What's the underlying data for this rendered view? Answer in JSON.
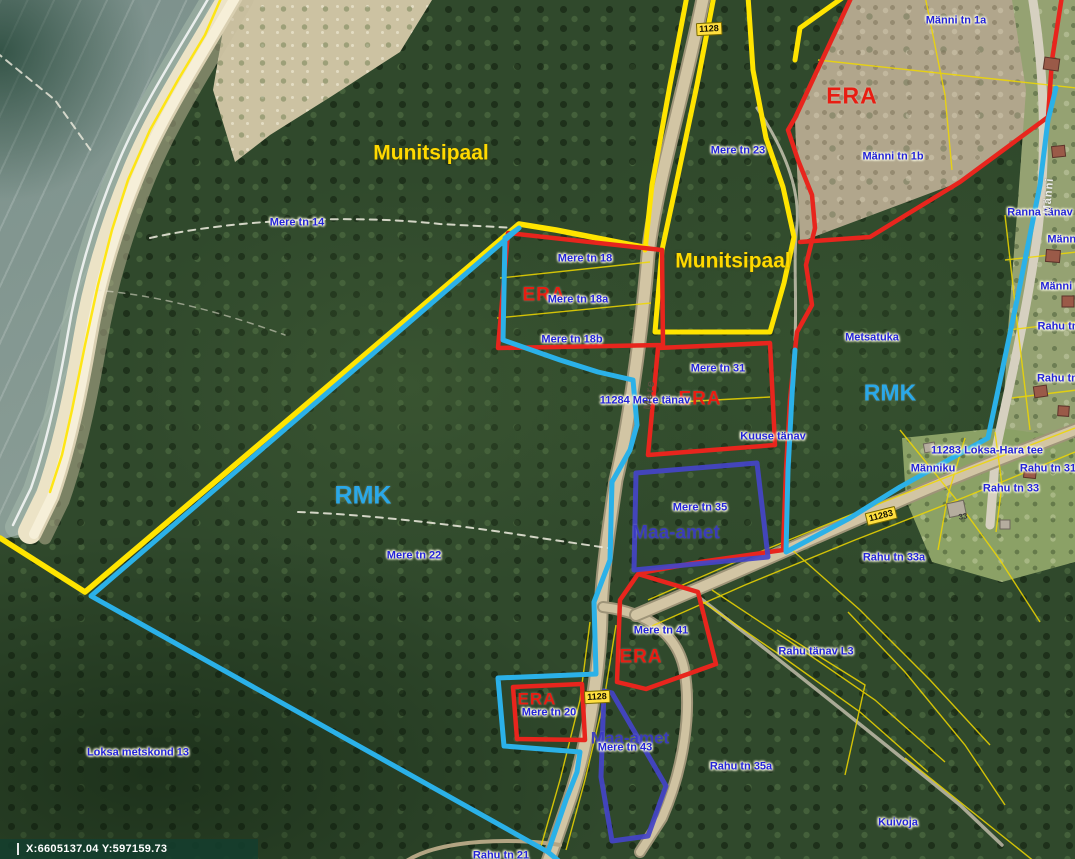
{
  "colors": {
    "boundary_yellow_municipal": "#ffe400",
    "boundary_red_era": "#e8251d",
    "boundary_cyan_rmk": "#2bb1e8",
    "boundary_purple_state": "#4444c8",
    "parcel_label_blue": "#2323d8",
    "road_badge_yellow": "#ffdf3f",
    "status_bar_green": "#143e2e"
  },
  "map": {
    "status_bar": {
      "coordinates": "X:6605137.04 Y:597159.73"
    },
    "badges": [
      {
        "text": "1128",
        "x": 709,
        "y": 29,
        "rot": -3
      },
      {
        "text": "11283",
        "x": 881,
        "y": 516,
        "rot": -14
      },
      {
        "text": "1128",
        "x": 597,
        "y": 697,
        "rot": -3
      }
    ],
    "labels": [
      {
        "text": "Munitsipaal",
        "x": 431,
        "y": 153,
        "type": "munitsipaal"
      },
      {
        "text": "Munitsipaal",
        "x": 733,
        "y": 261,
        "type": "munitsipaal"
      },
      {
        "text": "ERA",
        "x": 852,
        "y": 96,
        "type": "era",
        "size": 23
      },
      {
        "text": "ERA",
        "x": 544,
        "y": 295,
        "type": "era"
      },
      {
        "text": "ERA",
        "x": 700,
        "y": 399,
        "type": "era"
      },
      {
        "text": "ERA",
        "x": 641,
        "y": 657,
        "type": "era"
      },
      {
        "text": "ERA",
        "x": 537,
        "y": 699,
        "type": "era",
        "size": 17
      },
      {
        "text": "RMK",
        "x": 363,
        "y": 496,
        "type": "rmk",
        "size": 25
      },
      {
        "text": "RMK",
        "x": 890,
        "y": 393,
        "type": "rmk",
        "size": 23
      },
      {
        "text": "Maa-amet",
        "x": 676,
        "y": 533,
        "type": "maa"
      },
      {
        "text": "Maa-amet",
        "x": 630,
        "y": 738,
        "type": "maa",
        "size": 17
      },
      {
        "text": "Mere tn 14",
        "x": 297,
        "y": 223,
        "type": "parcel"
      },
      {
        "text": "Mere tn 23",
        "x": 738,
        "y": 151,
        "type": "parcel"
      },
      {
        "text": "Männi tn 1a",
        "x": 956,
        "y": 21,
        "type": "parcel"
      },
      {
        "text": "Männi tn 1b",
        "x": 893,
        "y": 157,
        "type": "parcel"
      },
      {
        "text": "Ranna tänav",
        "x": 1040,
        "y": 213,
        "type": "parcel"
      },
      {
        "text": "Männi tn",
        "x": 1070,
        "y": 240,
        "type": "parcel"
      },
      {
        "text": "Männi tn",
        "x": 1063,
        "y": 287,
        "type": "parcel"
      },
      {
        "text": "Mere tn 18",
        "x": 585,
        "y": 259,
        "type": "parcel"
      },
      {
        "text": "Mere tn 18a",
        "x": 578,
        "y": 300,
        "type": "parcel"
      },
      {
        "text": "Mere tn 18b",
        "x": 572,
        "y": 340,
        "type": "parcel"
      },
      {
        "text": "Mere tn 31",
        "x": 718,
        "y": 369,
        "type": "parcel"
      },
      {
        "text": "11284 Mere tänav",
        "x": 645,
        "y": 401,
        "type": "parcel"
      },
      {
        "text": "Kuuse tänav",
        "x": 773,
        "y": 437,
        "type": "parcel"
      },
      {
        "text": "Metsatuka",
        "x": 872,
        "y": 338,
        "type": "parcel"
      },
      {
        "text": "11283 Loksa-Hara tee",
        "x": 987,
        "y": 451,
        "type": "parcel"
      },
      {
        "text": "Männiku",
        "x": 933,
        "y": 469,
        "type": "parcel"
      },
      {
        "text": "Rahu tn 31",
        "x": 1048,
        "y": 469,
        "type": "parcel"
      },
      {
        "text": "Rahu tn 33",
        "x": 1011,
        "y": 489,
        "type": "parcel"
      },
      {
        "text": "Rahu tn",
        "x": 1058,
        "y": 327,
        "type": "parcel"
      },
      {
        "text": "Rahu tn 3",
        "x": 1062,
        "y": 379,
        "type": "parcel"
      },
      {
        "text": "Rahu tn 33a",
        "x": 894,
        "y": 558,
        "type": "parcel"
      },
      {
        "text": "Mere tn 22",
        "x": 414,
        "y": 556,
        "type": "parcel"
      },
      {
        "text": "Mere tn 35",
        "x": 700,
        "y": 508,
        "type": "parcel"
      },
      {
        "text": "Mere tn 41",
        "x": 661,
        "y": 631,
        "type": "parcel"
      },
      {
        "text": "Mere tn 20",
        "x": 549,
        "y": 713,
        "type": "parcel"
      },
      {
        "text": "Mere tn 43",
        "x": 625,
        "y": 748,
        "type": "parcel"
      },
      {
        "text": "Rahu tänav L3",
        "x": 816,
        "y": 652,
        "type": "parcel"
      },
      {
        "text": "Rahu tn 35a",
        "x": 741,
        "y": 767,
        "type": "parcel"
      },
      {
        "text": "Loksa metskond 13",
        "x": 138,
        "y": 753,
        "type": "parcel"
      },
      {
        "text": "Kuivoja",
        "x": 898,
        "y": 823,
        "type": "parcel"
      },
      {
        "text": "Rahu tn 21",
        "x": 501,
        "y": 856,
        "type": "parcel"
      },
      {
        "text": "33",
        "x": 963,
        "y": 517,
        "type": "house-number",
        "rot": -10
      },
      {
        "text": "Mere",
        "x": 650,
        "y": 395,
        "type": "road-name",
        "rot": -83
      },
      {
        "text": "Männi",
        "x": 1049,
        "y": 196,
        "type": "road-name-light",
        "rot": -85
      }
    ]
  }
}
